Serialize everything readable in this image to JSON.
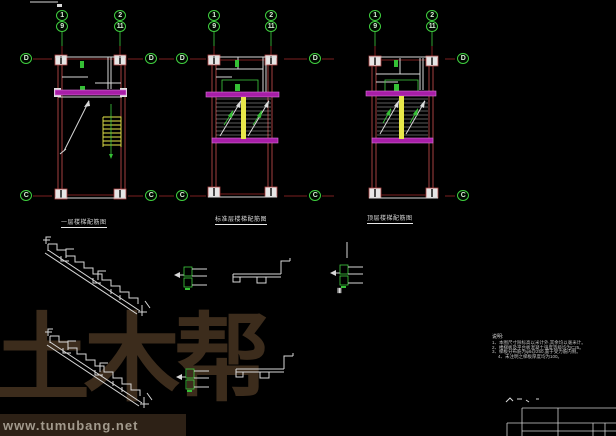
{
  "watermark": {
    "logo": "土木帮",
    "url": "www.tumubang.net"
  },
  "drawing": {
    "plans": [
      {
        "caption": "一层楼梯配筋图"
      },
      {
        "caption": "标准层楼梯配筋图"
      },
      {
        "caption": "顶层楼梯配筋图"
      }
    ],
    "axes": {
      "top_pairs": [
        {
          "top": "1",
          "bottom": "9"
        },
        {
          "top": "2",
          "bottom": "11"
        },
        {
          "top": "1",
          "bottom": "9"
        },
        {
          "top": "2",
          "bottom": "11"
        },
        {
          "top": "1",
          "bottom": "9"
        },
        {
          "top": "2",
          "bottom": "11"
        }
      ],
      "side": [
        {
          "label": "D"
        },
        {
          "label": "D"
        },
        {
          "label": "D"
        },
        {
          "label": "D"
        },
        {
          "label": "D"
        },
        {
          "label": "C"
        },
        {
          "label": "C"
        },
        {
          "label": "C"
        },
        {
          "label": "C"
        },
        {
          "label": "C"
        }
      ]
    },
    "section_mark": "Ⅲ",
    "notes": {
      "title": "说明:",
      "items": [
        "1、本图尺寸除标高以米计外,其余均以毫米计。",
        "2、楼梯板及平台板混凝土强度等级均为C25。",
        "3、梯板分布筋为φ6@250,置于受力筋内侧。",
        "4、未注明之梯板厚度均为100。"
      ]
    },
    "colors": {
      "background": "#000000",
      "axis_green": "#3fcf3f",
      "beam_magenta": "#a81ea8",
      "stair_yellow": "#e8e84a",
      "wall_red": "#a34040",
      "line_white": "#d8d8d8",
      "watermark_brown": "#3c2c1c"
    }
  }
}
